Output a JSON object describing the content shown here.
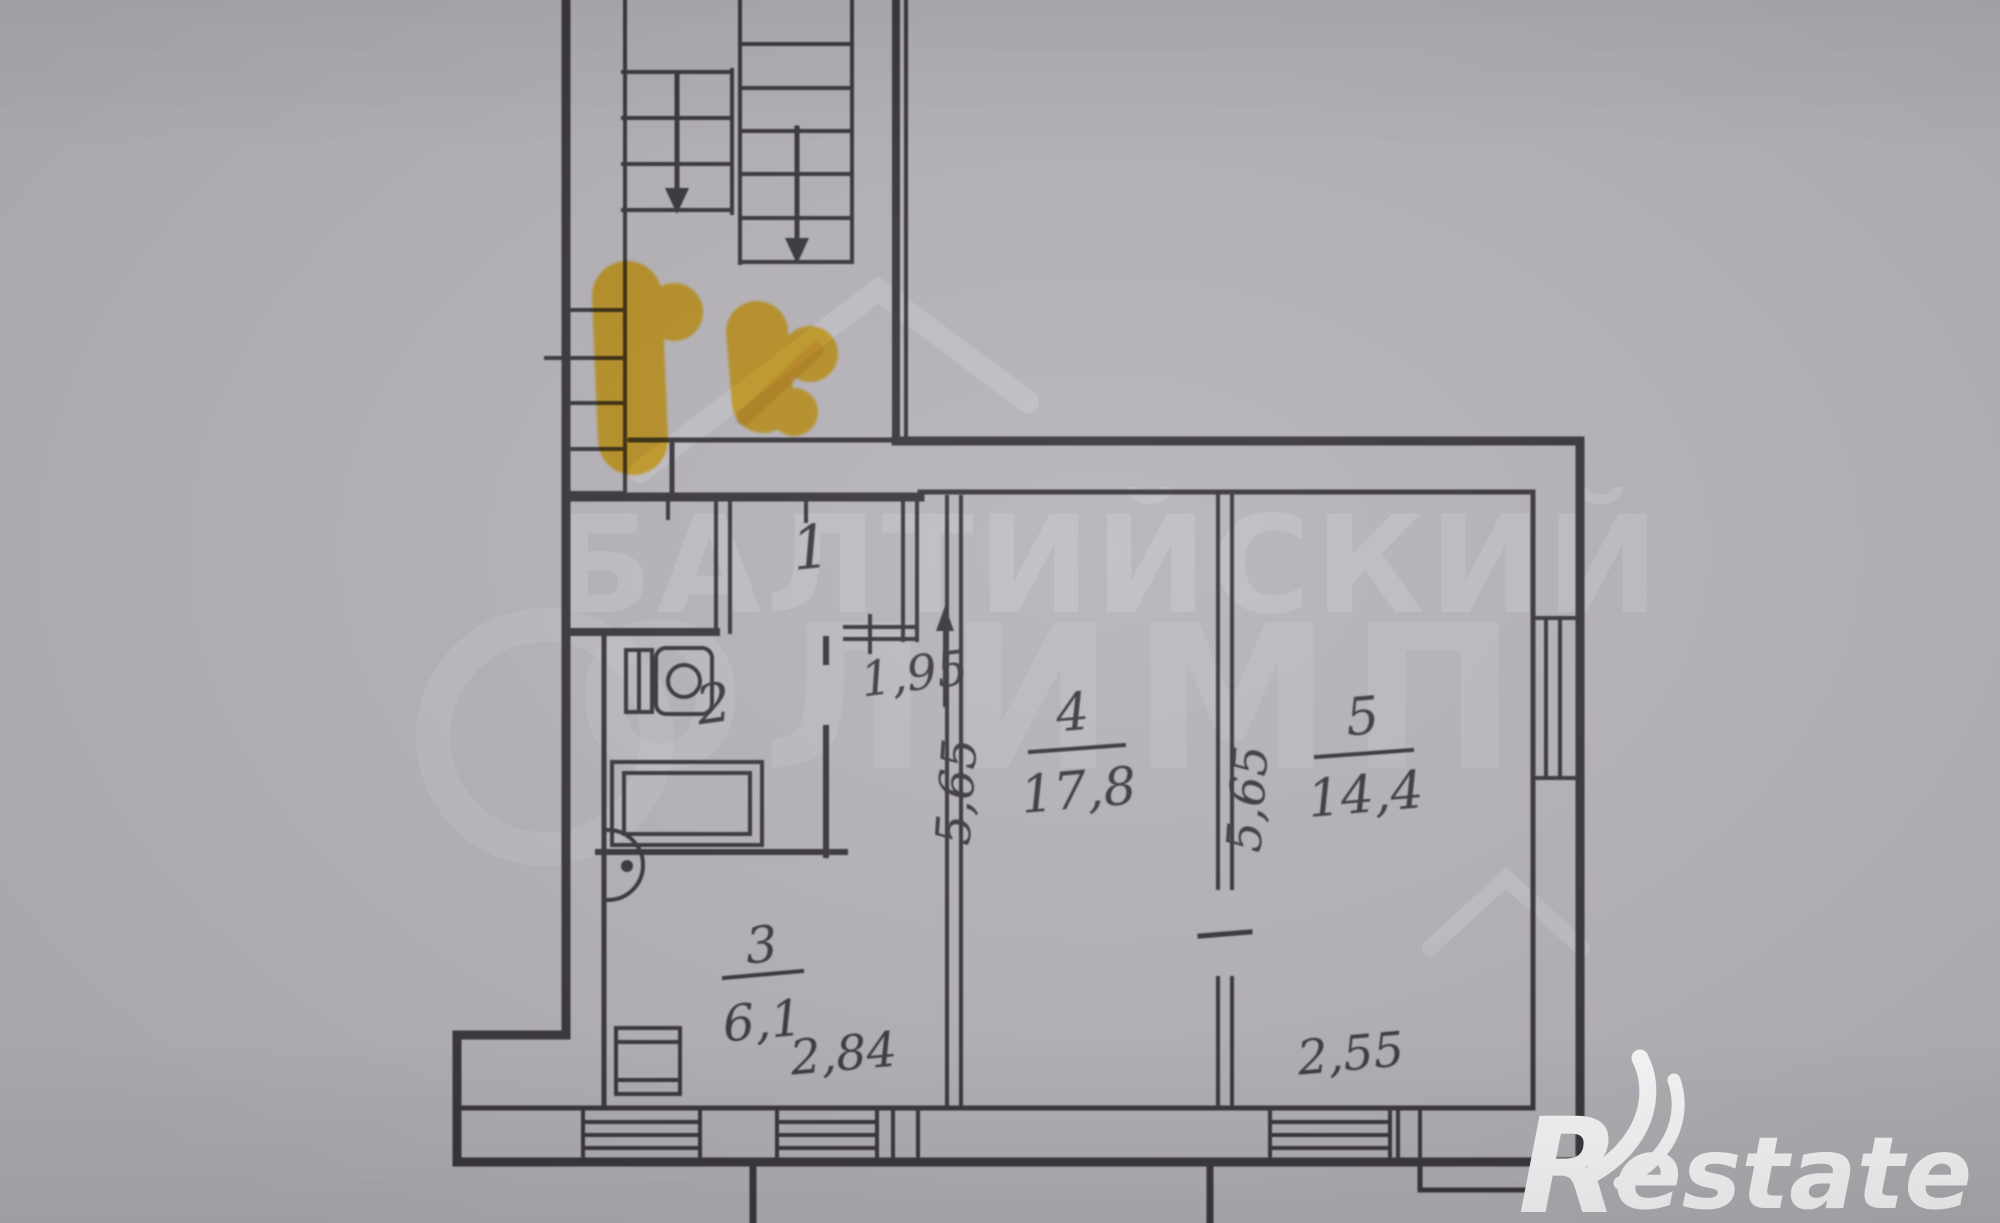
{
  "watermark": {
    "line1": "БАЛТИЙСКИЙ",
    "line2": "ОЛИМП"
  },
  "plan": {
    "rooms": [
      {
        "id": "hall",
        "number": "1"
      },
      {
        "id": "bathroom",
        "number": "2"
      },
      {
        "id": "kitchen",
        "number": "3",
        "area": "6,1"
      },
      {
        "id": "room4",
        "number": "4",
        "area": "17,8"
      },
      {
        "id": "room5",
        "number": "5",
        "area": "14,4"
      }
    ],
    "dimensions": {
      "hall_width": "1,95",
      "room4_depth": "5,65",
      "room5_depth": "5,65",
      "room4_width": "2,84",
      "room5_width": "2,55"
    }
  },
  "logo": {
    "r": "R",
    "suffix": "estate"
  },
  "colors": {
    "line": "#3a373c",
    "background": "#b6b4b9",
    "watermark": "#c9c8cd",
    "highlight": "#ffc61e",
    "highlight_stroke": "#f0a512",
    "logo_text": "#ffffff"
  }
}
